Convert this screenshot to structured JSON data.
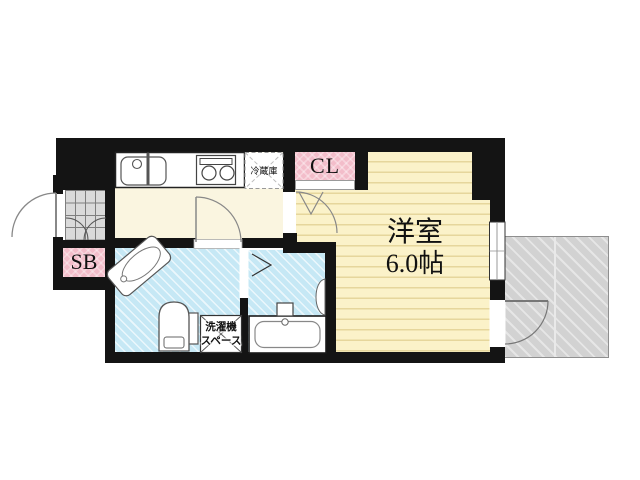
{
  "plan": {
    "rooms": {
      "main": {
        "label_line1": "洋室",
        "label_line2": "6.0帖"
      },
      "closet": {
        "label": "CL"
      },
      "shoebox": {
        "label": "SB"
      },
      "refrigerator": {
        "label": "冷蔵庫"
      },
      "laundry": {
        "label_line1": "洗濯機",
        "label_line2": "スペース"
      }
    },
    "colors": {
      "wall": "#141414",
      "main_room_floor": "#FBF2C9",
      "main_room_stripe": "#E6D69C",
      "kitchen_floor": "#FAF5E0",
      "wet_area_floor": "#C6E8F5",
      "closet_pink": "#F3BDCA",
      "entrance_tile": "#DADADA",
      "balcony_gray": "#D2D2D2",
      "door_line_gray": "#888888"
    }
  }
}
